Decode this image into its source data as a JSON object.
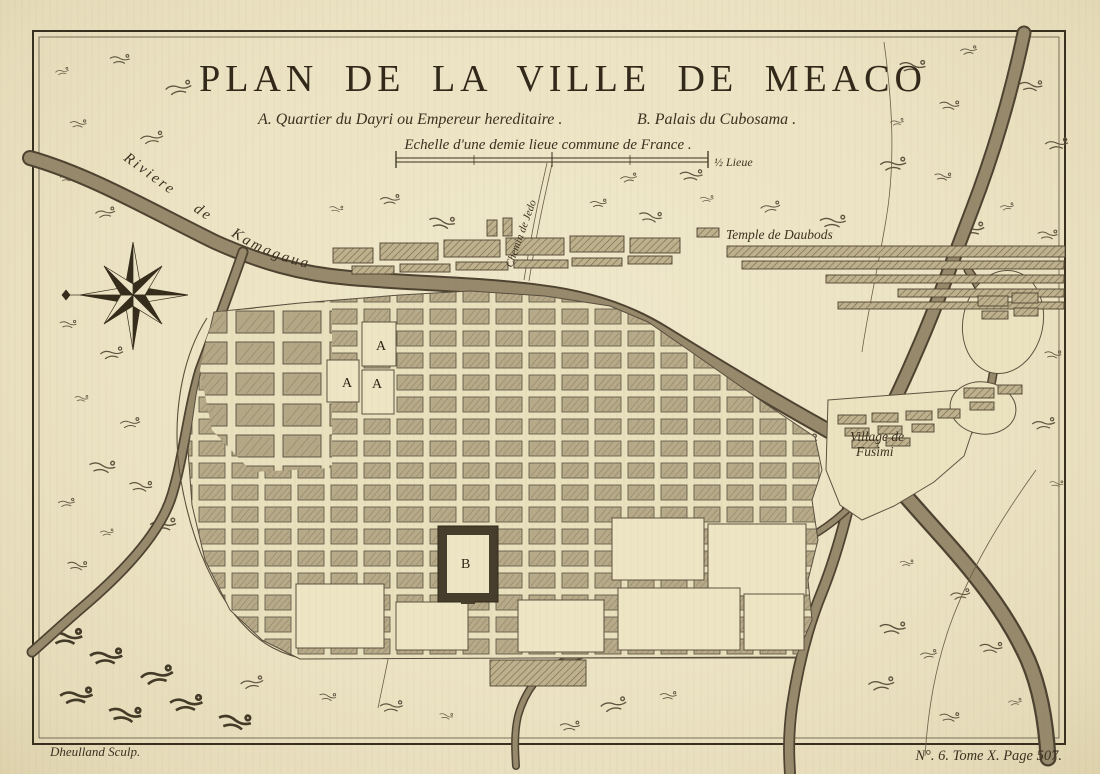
{
  "map": {
    "title": "PLAN DE LA VILLE DE MEACO",
    "legend_a": "A. Quartier du Dayri ou Empereur hereditaire .",
    "legend_b": "B. Palais du Cubosama .",
    "scale_caption": "Echelle d'une demie lieue commune de France .",
    "scale_unit": "½ Lieue",
    "labels": {
      "river_main": "Riviere de Kamagaua",
      "road_jedo": "Chemin de Jedo",
      "temple": "Temple de Daubods",
      "village_line1": "Village de",
      "village_line2": "Fusimi",
      "marker_a": "A",
      "marker_b": "B"
    },
    "imprint_left": "Dheulland Sculp.",
    "imprint_right": "N°. 6. Tome X. Page 507.",
    "colors": {
      "paper": "#ece3c4",
      "ink": "#3a3122",
      "river": "#96896c",
      "block": "#b6aa89"
    }
  }
}
